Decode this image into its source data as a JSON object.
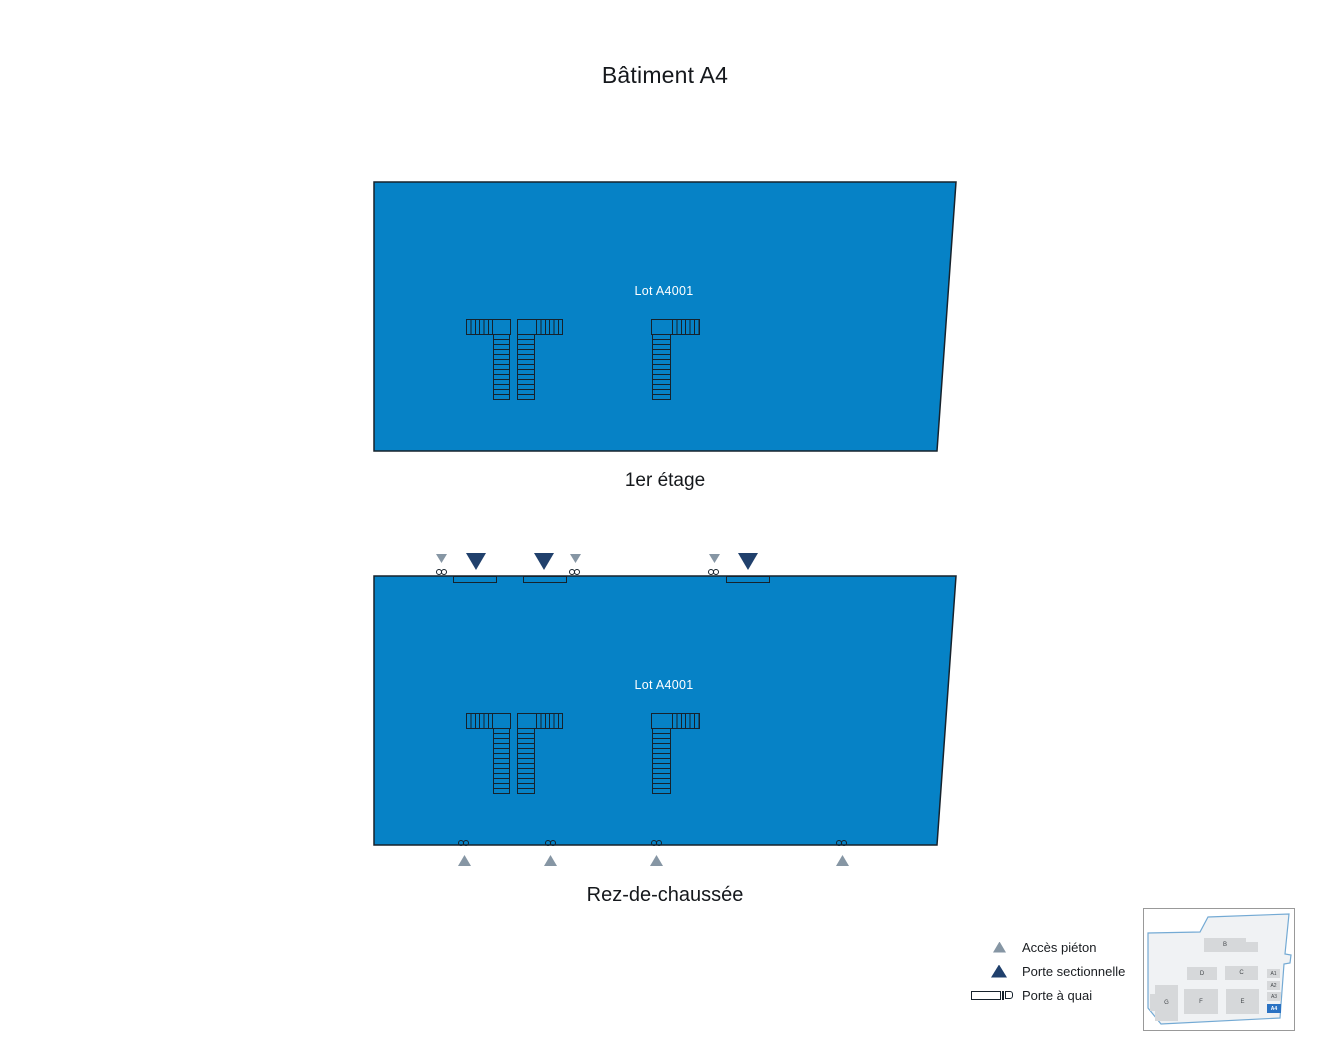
{
  "page": {
    "title": "Bâtiment A4"
  },
  "floors": {
    "first": {
      "label": "1er étage",
      "lot": "Lot A4001"
    },
    "ground": {
      "label": "Rez-de-chaussée",
      "lot": "Lot A4001"
    }
  },
  "legend": {
    "items": [
      {
        "icon": "pedestrian-access-triangle",
        "label": "Accès piéton"
      },
      {
        "icon": "sectional-door-triangle",
        "label": "Porte sectionnelle"
      },
      {
        "icon": "dock-door",
        "label": "Porte à quai"
      }
    ]
  },
  "minimap": {
    "highlighted": "A4",
    "buildings": {
      "B": {
        "label": "B"
      },
      "C": {
        "label": "C"
      },
      "D": {
        "label": "D"
      },
      "E": {
        "label": "E"
      },
      "F": {
        "label": "F"
      },
      "G": {
        "label": "G"
      },
      "A1": {
        "label": "A1"
      },
      "A2": {
        "label": "A2"
      },
      "A3": {
        "label": "A3"
      },
      "A4": {
        "label": "A4"
      }
    }
  },
  "colors": {
    "lot_fill": "#0682c6",
    "plan_outline": "#16222c",
    "pedestrian_access": "#8696a4",
    "sectional_door": "#20406c",
    "minimap_highlight": "#2a72c3"
  }
}
